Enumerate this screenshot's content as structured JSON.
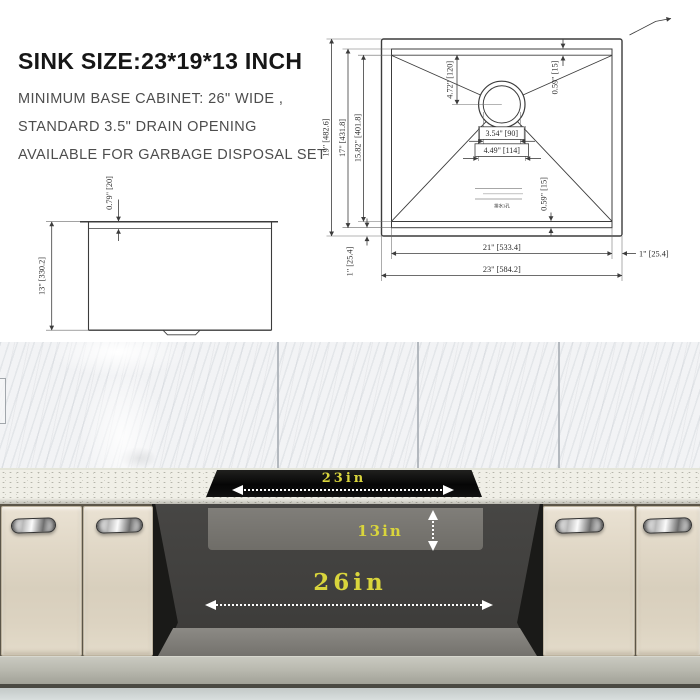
{
  "info": {
    "title": "SINK SIZE:23*19*13 INCH",
    "line1": "MINIMUM BASE CABINET: 26\" WIDE ,",
    "line2": "STANDARD 3.5\" DRAIN OPENING",
    "line3": "AVAILABLE FOR GARBAGE DISPOSAL SET"
  },
  "top_view": {
    "height_outer": "19\" [482.6]",
    "height_inner": "17\" [431.8]",
    "height_bowl": "15.82\" [401.8]",
    "drain_offset": "4.72\" [120]",
    "corner_radius_top": "0.59\" [15]",
    "corner_radius_bottom": "0.59\" [15]",
    "drain_inner_dia": "3.54\" [90]",
    "drain_outer_dia": "4.49\" [114]",
    "width_inner": "21\" [533.4]",
    "width_outer": "23\" [584.2]",
    "rim_right": "1\" [25.4]",
    "rim_left": "1\" [25.4]",
    "drain_note": "排水3孔"
  },
  "side_view": {
    "rim_height": "0.79\" [20]",
    "depth": "13\" [330.2]"
  },
  "install": {
    "sink_width": "23in",
    "sink_depth": "13in",
    "cabinet_width": "26in"
  },
  "colors": {
    "dim_yellow": "#d9d53c",
    "line_gray": "#3c3c3c",
    "cabinet_cream": "#ded5c4",
    "counter_white": "#f0efe7"
  }
}
